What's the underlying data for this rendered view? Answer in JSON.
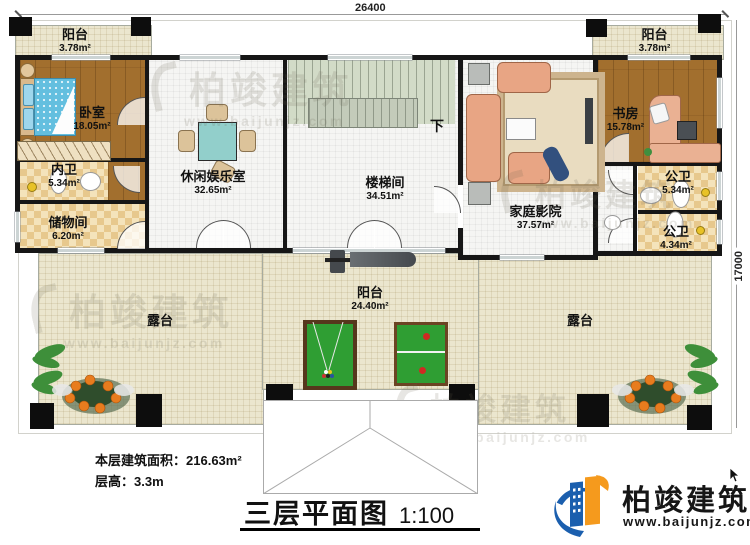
{
  "dimensions": {
    "width": "26400",
    "height": "17000"
  },
  "watermark": {
    "brand": "柏竣建筑",
    "url": "www.baijunjz.com"
  },
  "rooms": {
    "balcony_top_left": {
      "name": "阳台",
      "area": "3.78m²"
    },
    "balcony_top_right": {
      "name": "阳台",
      "area": "3.78m²"
    },
    "bedroom": {
      "name": "卧室",
      "area": "18.05m²"
    },
    "inner_bath": {
      "name": "内卫",
      "area": "5.34m²"
    },
    "storage": {
      "name": "储物间",
      "area": "6.20m²"
    },
    "rec_room": {
      "name": "休闲娱乐室",
      "area": "32.65m²"
    },
    "stairwell": {
      "name": "楼梯间",
      "area": "34.51m²",
      "down": "下"
    },
    "home_theater": {
      "name": "家庭影院",
      "area": "37.57m²"
    },
    "study": {
      "name": "书房",
      "area": "15.78m²"
    },
    "public_bath_upper": {
      "name": "公卫",
      "area": "5.34m²"
    },
    "public_bath_lower": {
      "name": "公卫",
      "area": "4.34m²"
    },
    "balcony_bottom": {
      "name": "阳台",
      "area": "24.40m²"
    },
    "terrace_left": {
      "name": "露台"
    },
    "terrace_right": {
      "name": "露台"
    }
  },
  "footer": {
    "floor_area_label": "本层建筑面积：",
    "floor_area_value": "216.63m²",
    "floor_height": "层高：3.3m",
    "title": "三层平面图",
    "scale": "1:100"
  },
  "logo": {
    "brand": "柏竣建筑",
    "url": "www.baijunjz.com"
  },
  "colors": {
    "wall": "#161616",
    "wood": "#a26f2e",
    "terr": "#ebe6ce",
    "room": "#f5f5f3",
    "stairs": "#d2dbc7",
    "teal": "#92cfcb",
    "green": "#2f9e33",
    "sofa": "#e8a584",
    "blue": "#1b5fae",
    "orange": "#f59a1d"
  }
}
